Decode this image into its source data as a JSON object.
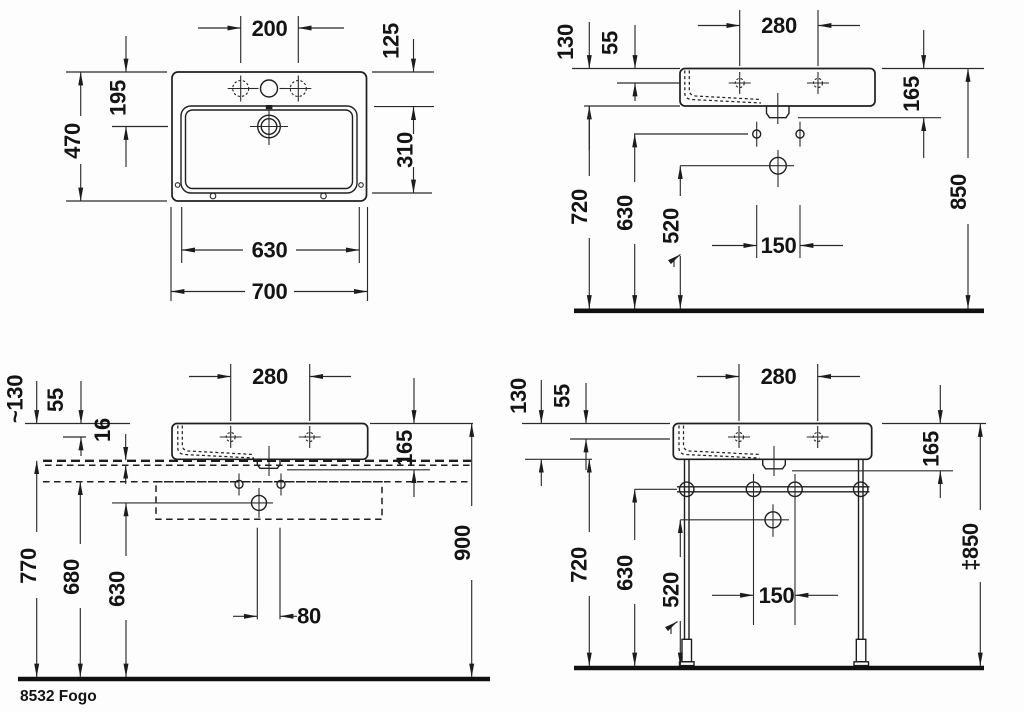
{
  "drawing": {
    "product_label": "8532 Fogo",
    "views": {
      "plan": {
        "dims": {
          "tap_spacing": "200",
          "rim_to_bowl": "125",
          "drain_from_back": "195",
          "overall_depth": "470",
          "bowl_depth": "310",
          "bowl_width": "630",
          "overall_width": "700"
        }
      },
      "front_wall": {
        "dims": {
          "tap_spacing": "280",
          "body_height": "130",
          "tap_below_rim": "55",
          "body_with_drain": "165",
          "underside_height": "720",
          "fixing_height": "630",
          "outlet_height": "520",
          "fixing_spacing": "150",
          "rim_height": "850"
        }
      },
      "front_console": {
        "dims": {
          "body_height": "~130",
          "tap_below_rim": "55",
          "plate_thickness": "16",
          "tap_spacing": "280",
          "body_with_drain": "165",
          "console_top_height": "770",
          "underside_height": "680",
          "outlet_height": "630",
          "drain_width": "80",
          "rim_height": "900"
        }
      },
      "front_stand": {
        "dims": {
          "body_height": "130",
          "tap_below_rim": "55",
          "tap_spacing": "280",
          "body_with_drain": "165",
          "underside_height": "720",
          "rail_height": "630",
          "outlet_height": "520",
          "fixing_spacing": "150",
          "rim_height_adjustable": "‡850"
        }
      }
    }
  }
}
